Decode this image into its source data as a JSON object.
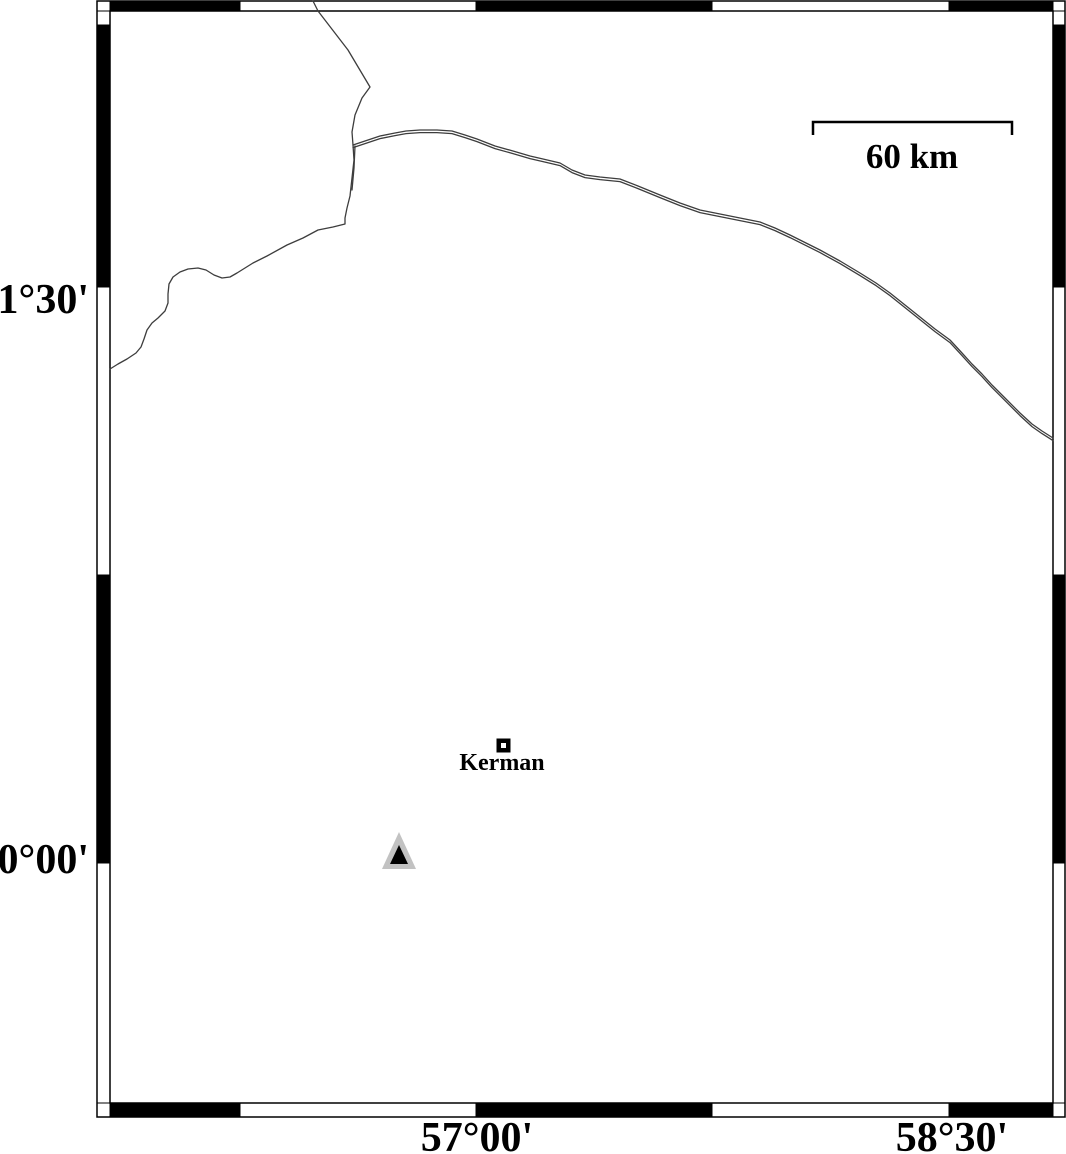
{
  "title": "Kerman region map",
  "colors": {
    "background": "#ffffff",
    "frame": "#000000",
    "band_white": "#ffffff",
    "band_black": "#000000",
    "border_line": "#3d3d3d",
    "station_gray": "#c2c2c2",
    "station_black": "#000000",
    "text": "#000000"
  },
  "frame": {
    "outer": {
      "x1": 97,
      "y1": 1,
      "x2": 1065,
      "y2": 1117
    },
    "inner": {
      "x1": 110,
      "y1": 11,
      "x2": 1053,
      "y2": 1103
    },
    "x_cells": {
      "bounds": [
        97,
        110,
        240,
        476,
        712,
        949,
        1053,
        1065
      ],
      "fills": [
        "white",
        "black",
        "white",
        "black",
        "white",
        "black",
        "white"
      ]
    },
    "y_cells": {
      "bounds": [
        1,
        11,
        25,
        287,
        575,
        863,
        1103,
        1117
      ],
      "fills": [
        "white",
        "white",
        "black",
        "white",
        "black",
        "white",
        "white"
      ]
    }
  },
  "axis_labels": {
    "left": [
      {
        "text": "31°30'",
        "x": 89,
        "y": 300
      },
      {
        "text": "30°00'",
        "x": 89,
        "y": 860
      }
    ],
    "bottom": [
      {
        "text": "57°00'",
        "x": 477,
        "y": 1151
      },
      {
        "text": "58°30'",
        "x": 952,
        "y": 1151
      }
    ]
  },
  "scalebar": {
    "label": "60 km",
    "x1": 813,
    "x2": 1012,
    "y": 122,
    "tick_len": 13,
    "label_x": 912,
    "label_y": 168
  },
  "city": {
    "name": "Kerman",
    "x": 503.5,
    "y": 745.5,
    "label_x": 502,
    "label_y": 770
  },
  "station": {
    "outer": [
      [
        399,
        832
      ],
      [
        382,
        869
      ],
      [
        416,
        869
      ]
    ],
    "inner": [
      [
        399,
        845
      ],
      [
        390,
        864
      ],
      [
        408,
        864
      ]
    ]
  },
  "borders": {
    "province": [
      [
        313,
        1
      ],
      [
        318,
        11
      ],
      [
        348,
        50
      ],
      [
        370,
        87
      ],
      [
        362,
        98
      ],
      [
        355,
        115
      ],
      [
        352,
        132
      ],
      [
        353,
        145
      ],
      [
        354,
        160
      ],
      [
        352,
        178
      ],
      [
        350,
        196
      ],
      [
        347,
        208
      ],
      [
        345,
        218
      ],
      [
        345,
        224
      ],
      [
        333,
        227
      ],
      [
        318,
        230
      ],
      [
        303,
        238
      ],
      [
        287,
        245
      ],
      [
        267,
        256
      ],
      [
        253,
        263
      ],
      [
        237,
        273
      ],
      [
        230,
        277
      ],
      [
        222,
        278
      ],
      [
        214,
        275
      ],
      [
        206,
        270
      ],
      [
        198,
        268
      ],
      [
        188,
        269
      ],
      [
        180,
        272
      ],
      [
        173,
        277
      ],
      [
        169,
        284
      ],
      [
        168,
        294
      ],
      [
        168,
        303
      ],
      [
        165,
        311
      ],
      [
        158,
        318
      ],
      [
        152,
        323
      ],
      [
        147,
        330
      ],
      [
        144,
        339
      ],
      [
        141,
        347
      ],
      [
        136,
        353
      ],
      [
        127,
        359
      ],
      [
        118,
        364
      ],
      [
        110,
        369
      ]
    ],
    "double_border": [
      [
        353,
        145
      ],
      [
        368,
        140
      ],
      [
        380,
        136
      ],
      [
        395,
        133
      ],
      [
        406,
        131
      ],
      [
        420,
        130
      ],
      [
        437,
        130
      ],
      [
        452,
        131
      ],
      [
        465,
        135
      ],
      [
        477,
        139
      ],
      [
        495,
        146
      ],
      [
        513,
        151
      ],
      [
        530,
        156
      ],
      [
        543,
        159
      ],
      [
        560,
        163
      ],
      [
        572,
        170
      ],
      [
        585,
        175
      ],
      [
        600,
        177
      ],
      [
        620,
        179
      ],
      [
        638,
        186
      ],
      [
        660,
        195
      ],
      [
        680,
        203
      ],
      [
        700,
        210
      ],
      [
        720,
        214
      ],
      [
        740,
        218
      ],
      [
        760,
        222
      ],
      [
        775,
        228
      ],
      [
        790,
        235
      ],
      [
        806,
        243
      ],
      [
        820,
        250
      ],
      [
        840,
        261
      ],
      [
        860,
        273
      ],
      [
        876,
        283
      ],
      [
        890,
        293
      ],
      [
        905,
        305
      ],
      [
        920,
        317
      ],
      [
        935,
        329
      ],
      [
        950,
        340
      ],
      [
        962,
        353
      ],
      [
        972,
        364
      ],
      [
        982,
        374
      ],
      [
        992,
        385
      ],
      [
        1006,
        399
      ],
      [
        1020,
        413
      ],
      [
        1032,
        424
      ],
      [
        1042,
        431
      ],
      [
        1053,
        438
      ]
    ],
    "double_border_offset": 2.6,
    "double_border_spur": [
      [
        355,
        146
      ],
      [
        354,
        168
      ],
      [
        352,
        190
      ]
    ]
  }
}
